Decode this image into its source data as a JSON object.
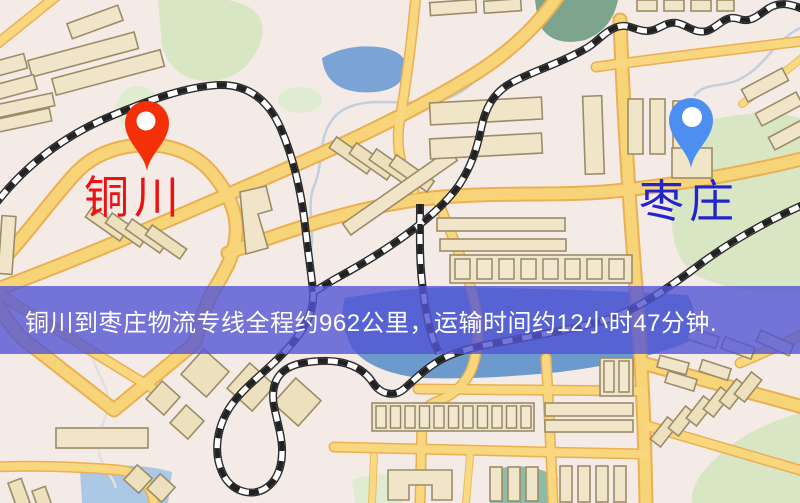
{
  "map": {
    "markers": [
      {
        "city": "铜川",
        "role": "origin",
        "icon": "map-pin",
        "pin_color": "#f33008",
        "label_color": "#ee1111"
      },
      {
        "city": "枣庄",
        "role": "destination",
        "icon": "map-pin",
        "pin_color": "#4d8ff0",
        "label_color": "#2424cc"
      }
    ],
    "banner": {
      "text": "铜川到枣庄物流专线全程约962公里，运输时间约12小时47分钟.",
      "background": "#5355d4",
      "text_color": "#ffffff"
    },
    "route": {
      "origin": "铜川",
      "destination": "枣庄",
      "distance_text": "约962公里",
      "duration_text": "约12小时47分钟"
    }
  },
  "colors": {
    "land": "#f4eae6",
    "road_fill": "#f7d477",
    "road_casing": "#e9b054",
    "water": "#7aa4d6",
    "park": "#d8e6c4",
    "building": "#f0e5c8",
    "building_outline": "#9c8c68",
    "railway": "#2b2b2b",
    "banner_overlay": "#5355d4"
  }
}
